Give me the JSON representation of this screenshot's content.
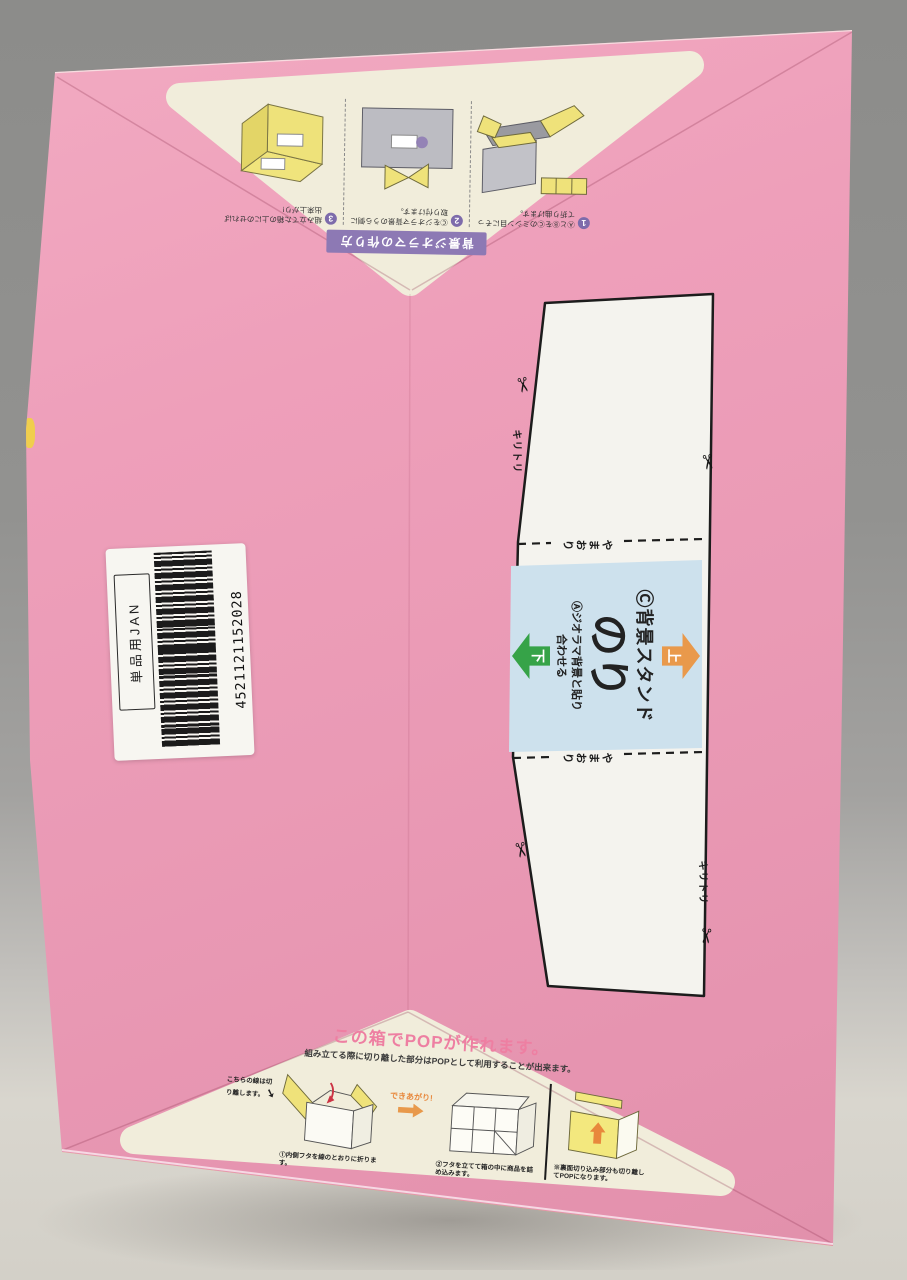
{
  "colors": {
    "box_pink": "#ea9ab5",
    "cream": "#f1eddb",
    "banner_purple": "#8d79b4",
    "panel_blue": "#cde1ed",
    "arrow_orange": "#e9994b",
    "arrow_green": "#36a348",
    "title_pink": "#ee7fa2",
    "edge_yellow": "#e9cc49"
  },
  "barcode": {
    "label": "単品用JAN",
    "number": "4521121152028"
  },
  "template": {
    "kiritori": "キリトリ",
    "yamaori": "やまおり",
    "scissors_icon": "✂",
    "panel": {
      "up": "上",
      "down": "下",
      "line_c": "Ⓒ背景スタンド",
      "nori": "のり",
      "line_a": "Ⓐジオラマ背景と貼り合わせる"
    }
  },
  "top_instructions": {
    "banner": "背景ジオラマの作り方",
    "steps": [
      {
        "num": "1",
        "caption": "ⒶとⒷをⒸのミシン目にそって折り曲げます。"
      },
      {
        "num": "2",
        "caption": "Ⓒをジオラマ背景のうら側に取り付けます。"
      },
      {
        "num": "3",
        "caption": "組み立てた箱の上にのせれば出来上がり!"
      }
    ]
  },
  "pop_instructions": {
    "title": "この箱でPOPが作れます。",
    "subtitle": "組み立てる際に切り離した部分はPOPとして利用することが出来ます。",
    "note": "こちらの線は切り離します。",
    "note_arrow": "➘",
    "done_label": "できあがり!",
    "captions": [
      "①内側フタを線のとおりに折ります。",
      "②フタを立てて箱の中に商品を詰め込みます。",
      "※裏面切り込み部分も切り離してPOPになります。"
    ]
  }
}
